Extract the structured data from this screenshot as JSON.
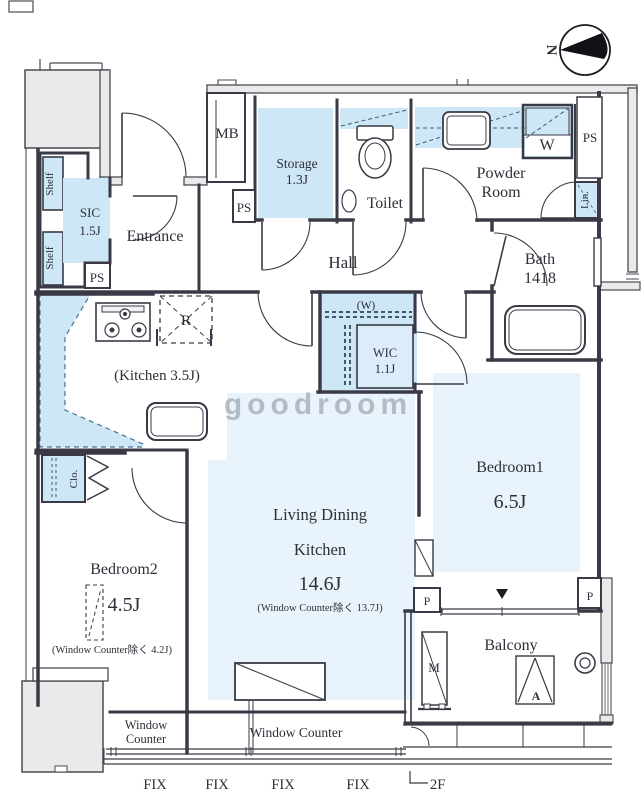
{
  "compass": {
    "north_label": "N"
  },
  "watermark_text": "goodroom",
  "rooms": {
    "entrance": {
      "label": "Entrance"
    },
    "sic": {
      "name": "SIC",
      "size": "1.5J"
    },
    "hall": {
      "label": "Hall"
    },
    "storage": {
      "name": "Storage",
      "size": "1.3J"
    },
    "toilet": {
      "label": "Toilet"
    },
    "powder": {
      "line1": "Powder",
      "line2": "Room"
    },
    "bath": {
      "name": "Bath",
      "size": "1418"
    },
    "kitchen": {
      "label": "(Kitchen 3.5J)"
    },
    "wic": {
      "name": "WIC",
      "size": "1.1J",
      "pipe_note": "(W)"
    },
    "ldk": {
      "line1": "Living Dining",
      "line2": "Kitchen",
      "size": "14.6J",
      "note": "(Window Counter除く 13.7J)"
    },
    "bedroom1": {
      "name": "Bedroom1",
      "size": "6.5J"
    },
    "bedroom2": {
      "name": "Bedroom2",
      "size": "4.5J",
      "note": "(Window Counter除く 4.2J)"
    },
    "balcony": {
      "label": "Balcony"
    }
  },
  "fixtures": {
    "meter_box": "MB",
    "pipe_space": "PS",
    "washer": "W",
    "linen": "Lin.",
    "shelf": "Shelf",
    "closet": "Clo.",
    "refrigerator": "R",
    "meter": "M",
    "aircon": "A",
    "pillar": "P"
  },
  "openings": {
    "window_counter_word1": "Window",
    "window_counter_word2": "Counter",
    "window_counter": "Window Counter",
    "fix": "FIX"
  },
  "floor_mark": "2F",
  "colors": {
    "accent_blue": "#cde7f6",
    "pad_blue": "#e9f3fb",
    "wall": "#3a3a46",
    "exterior": "#eaeaea",
    "watermark": "#8fc1e0"
  }
}
